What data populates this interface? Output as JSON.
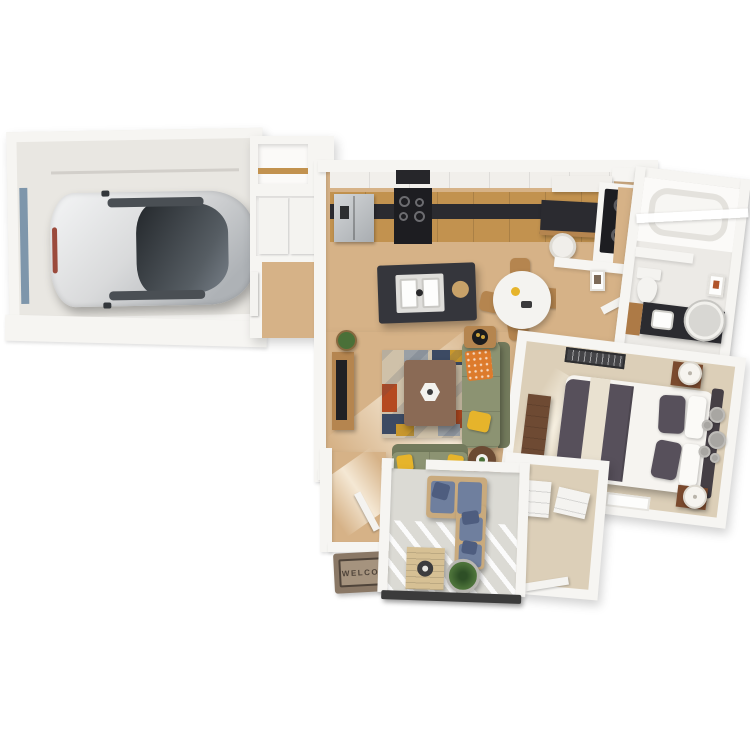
{
  "scene": {
    "type": "3d-floor-plan-render",
    "view": "top-down isometric apartment with attached garage",
    "background": "#ffffff"
  },
  "labels": {
    "welcome_mat": "WELCOME"
  },
  "palette": {
    "wall": "#f6f5f2",
    "concrete": "#e9e7e2",
    "floorwood": "#d6b287",
    "floorwoodlight": "#e8d2ab",
    "carpet": "#dccfb8",
    "patiofloor": "#dbdad4",
    "tile": "#eceae6",
    "cabinetwood": "#c2924f",
    "counterdark": "#2b2b30",
    "stainless": "#bfc3c6",
    "black": "#1d1d21",
    "islanddark": "#35363c",
    "sinkwhite": "#f4f3f0",
    "chairwood": "#b5854f",
    "sofagreen": "#8c9372",
    "sofagreendark": "#737a5c",
    "pillowyellow": "#e6b42b",
    "throworange": "#dd7b2c",
    "rugbase": "#cfc1a9",
    "rugnavy": "#3c4a63",
    "rugrust": "#b54a20",
    "ruggray": "#9aa0a6",
    "rugmustard": "#c8972d",
    "coffeetable": "#8a6a55",
    "bedcharcoal": "#57505b",
    "bedcream": "#e9e1d0",
    "headboard": "#453f45",
    "nightstand": "#7a4a2e",
    "dresser": "#6e4a33",
    "outdoorblue": "#6f7f9e",
    "outdoorbluedark": "#4e5d7f",
    "outdoorwood": "#c9aa7d",
    "plantgreen": "#4a7038",
    "matbrown": "#8a7866",
    "matinner": "#a5937e",
    "mattext": "#4f443a",
    "raildark": "#3b3b3b",
    "glass": "#3c4147",
    "carsilver": "#d9dadb",
    "doorblue": "#7e96ab"
  },
  "rooms": [
    "garage",
    "entry-hall",
    "pantry",
    "kitchen",
    "dining-area",
    "living-room",
    "desk-nook",
    "laundry-closet",
    "bathroom",
    "bedroom",
    "walk-in-closet",
    "patio"
  ],
  "furniture": [
    "car",
    "refrigerator",
    "range",
    "kitchen-island-double-sink",
    "round-dining-table",
    "dining-chairs",
    "desk",
    "desk-chair",
    "stacked-washer-dryer",
    "bathtub",
    "toilet",
    "vanity-lighted-mirror",
    "queen-bed",
    "nightstands",
    "table-lamps",
    "dresser",
    "wall-circle-decor",
    "tv-console",
    "television",
    "green-sofa",
    "green-loveseat",
    "geometric-rug",
    "coffee-table",
    "side-tables",
    "outdoor-sectional",
    "outdoor-coffee-table",
    "potted-plants",
    "welcome-mat"
  ]
}
